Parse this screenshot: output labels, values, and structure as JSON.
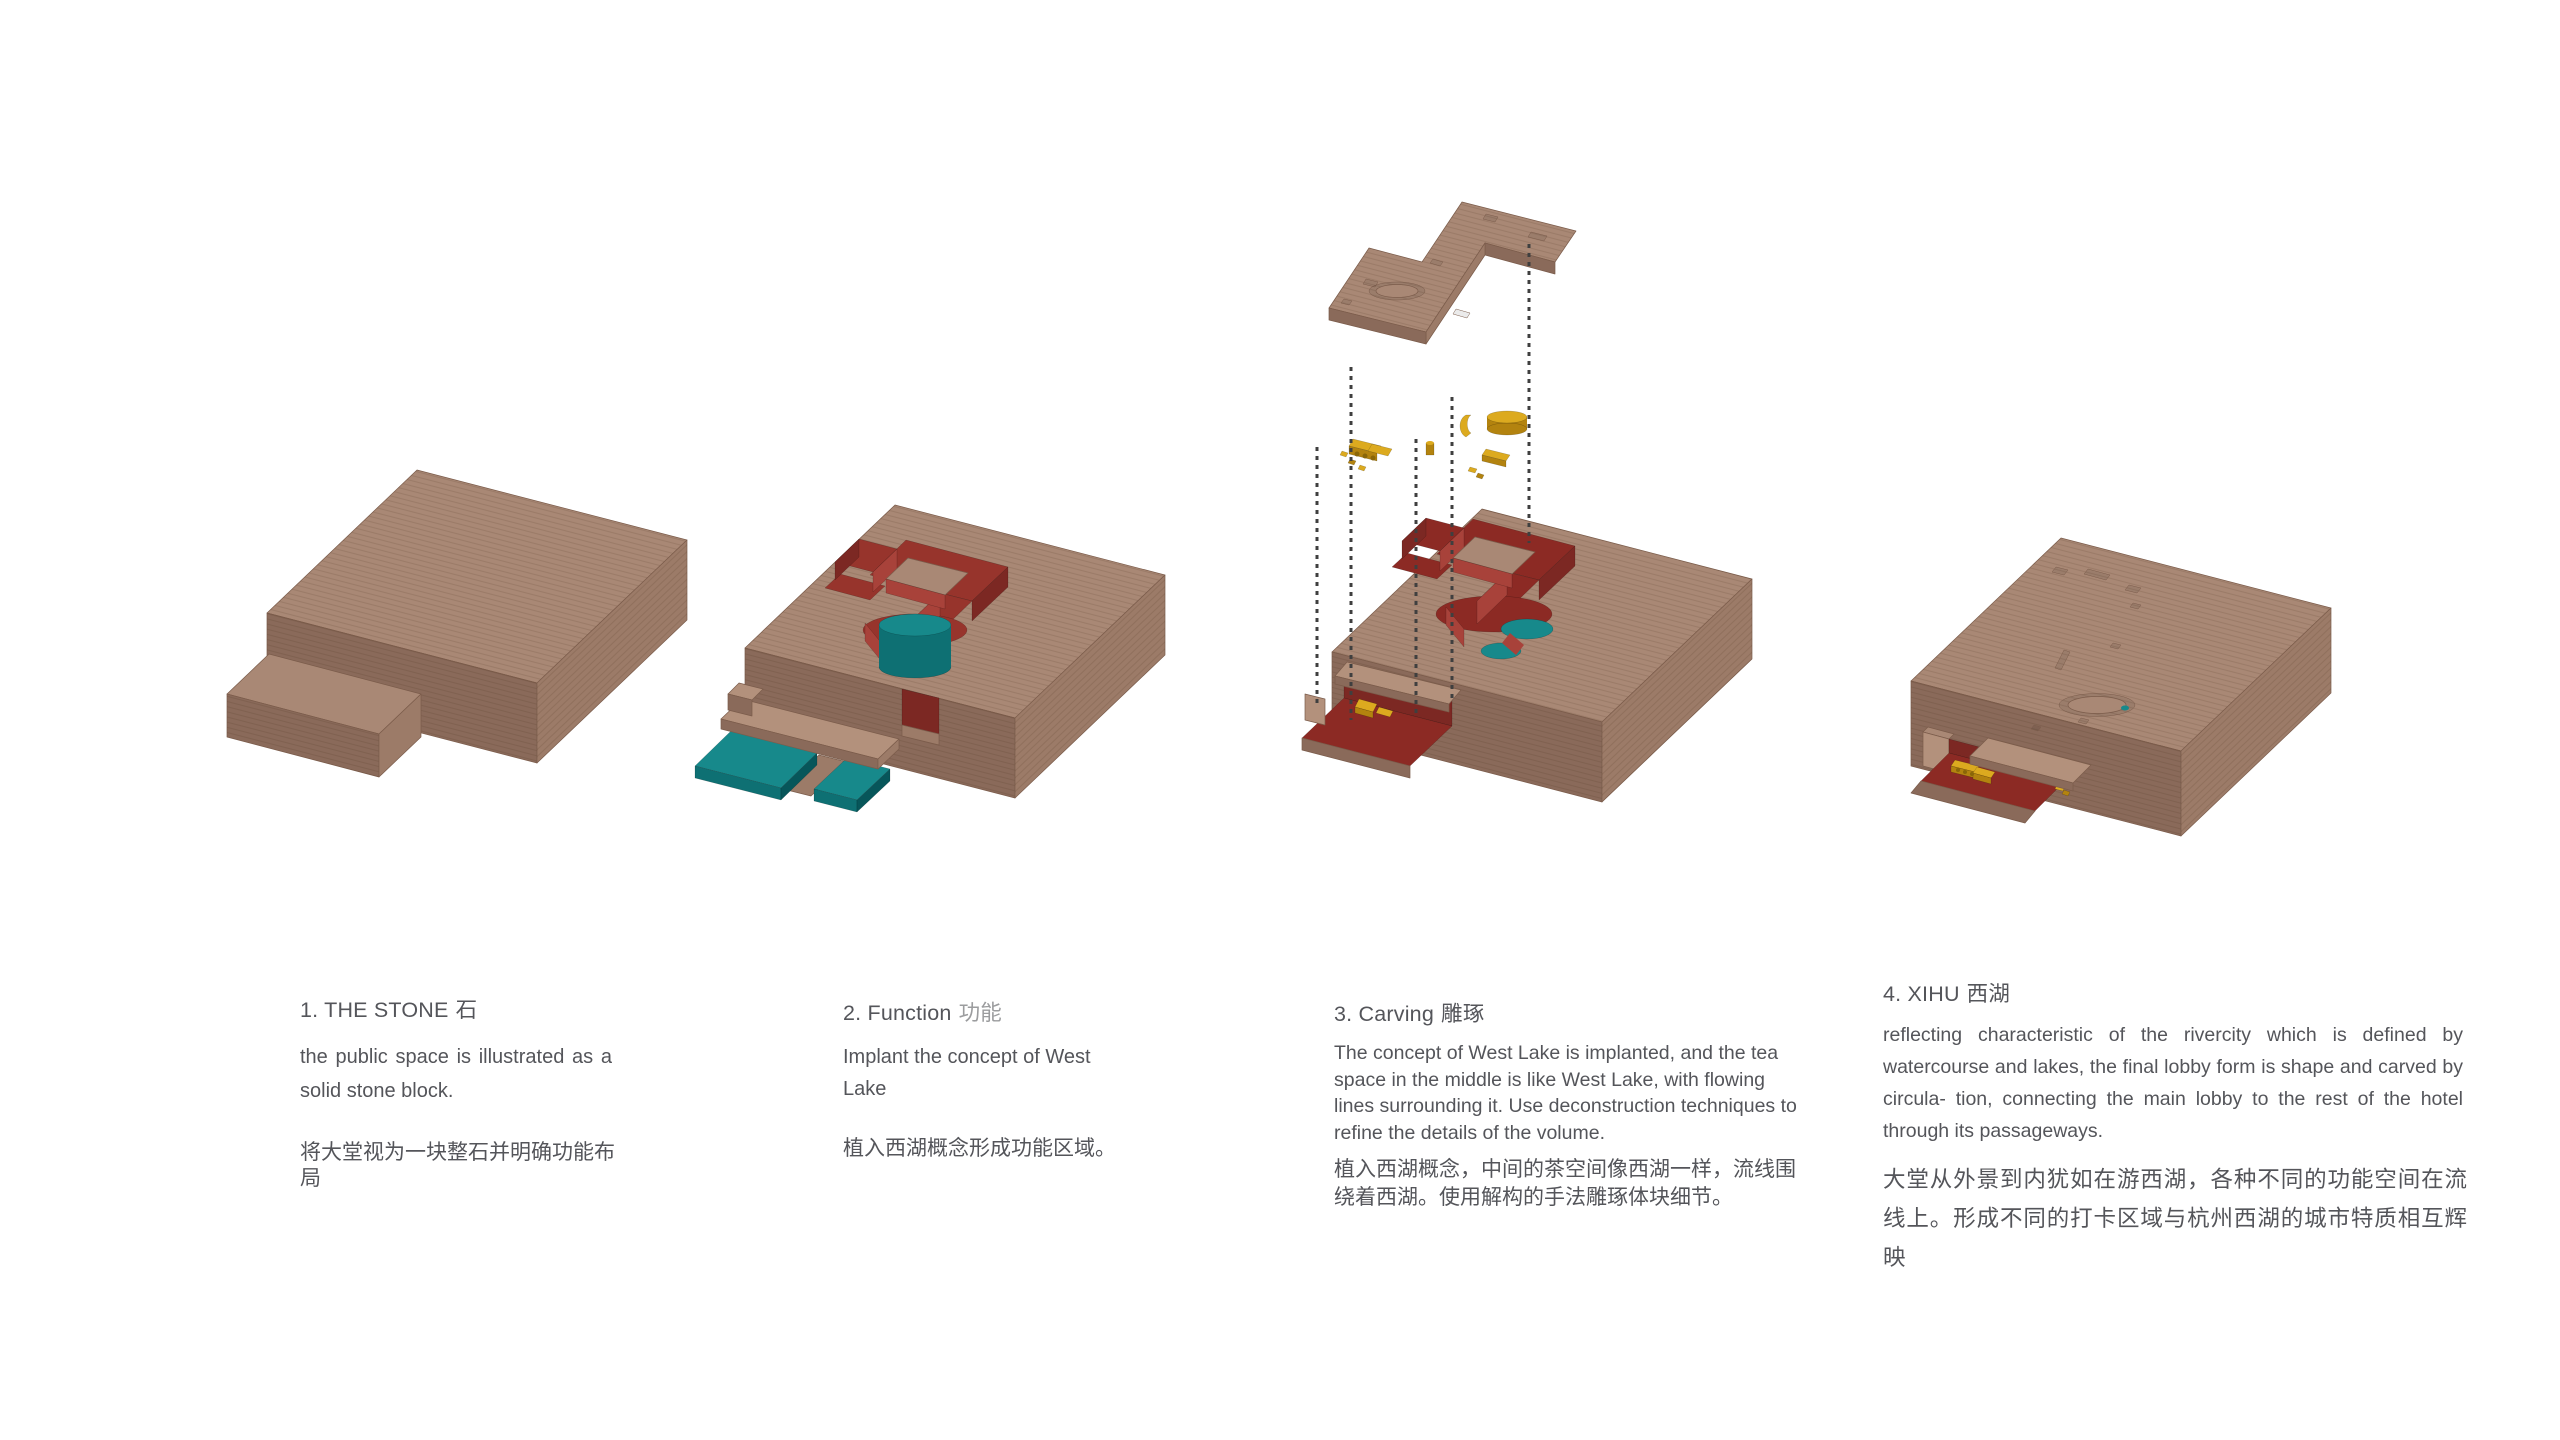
{
  "page": {
    "background": "#ffffff",
    "type": "architectural-concept-diagram"
  },
  "colors": {
    "wood-top": "#a98875",
    "wood-left": "#8a6a5a",
    "wood-right": "#9c7b68",
    "wood-plank": "#b3917c",
    "wood-edge": "#7b5c4b",
    "red-wall": "#a8423a",
    "red-floor": "#97342c",
    "red-floor-dark": "#8c2a24",
    "red-dark": "#7c2823",
    "teal": "#17898b",
    "teal-side": "#0e7073",
    "teal-dark": "#07565a",
    "gold": "#dcaa1f",
    "gold-side": "#b3830f",
    "gold-dark": "#8a6608",
    "dot-line": "#3f3f3f",
    "text": "#54555a",
    "text-light": "#9b9c9e",
    "background": "#ffffff"
  },
  "sections": [
    {
      "label": "1. THE STONE",
      "label_cjk": "石",
      "en": "the public space is illustrated as a solid stone block.",
      "zh": "将大堂视为一块整石并明确功能布局"
    },
    {
      "label": "2. Function",
      "label_cjk": "功能",
      "en": "Implant the concept of West Lake",
      "zh": "植入西湖概念形成功能区域。"
    },
    {
      "label": "3. Carving",
      "label_cjk": "雕琢",
      "en": "The concept of West Lake is implanted, and the tea space in the middle is like West Lake, with flowing lines surrounding it. Use deconstruction techniques to refine the details of the volume.",
      "zh": "植入西湖概念，中间的茶空间像西湖一样，流线围绕着西湖。使用解构的手法雕琢体块细节。"
    },
    {
      "label": "4. XIHU",
      "label_cjk": "西湖",
      "en": "reflecting characteristic of the rivercity which is defined by watercourse and lakes, the final lobby form is shape and carved by circula- tion, connecting the main lobby to the rest of the hotel through its passageways.",
      "zh": "大堂从外景到内犹如在游西湖，各种不同的功能空间在流线上。形成不同的打卡区域与杭州西湖的城市特质相互辉映"
    }
  ]
}
